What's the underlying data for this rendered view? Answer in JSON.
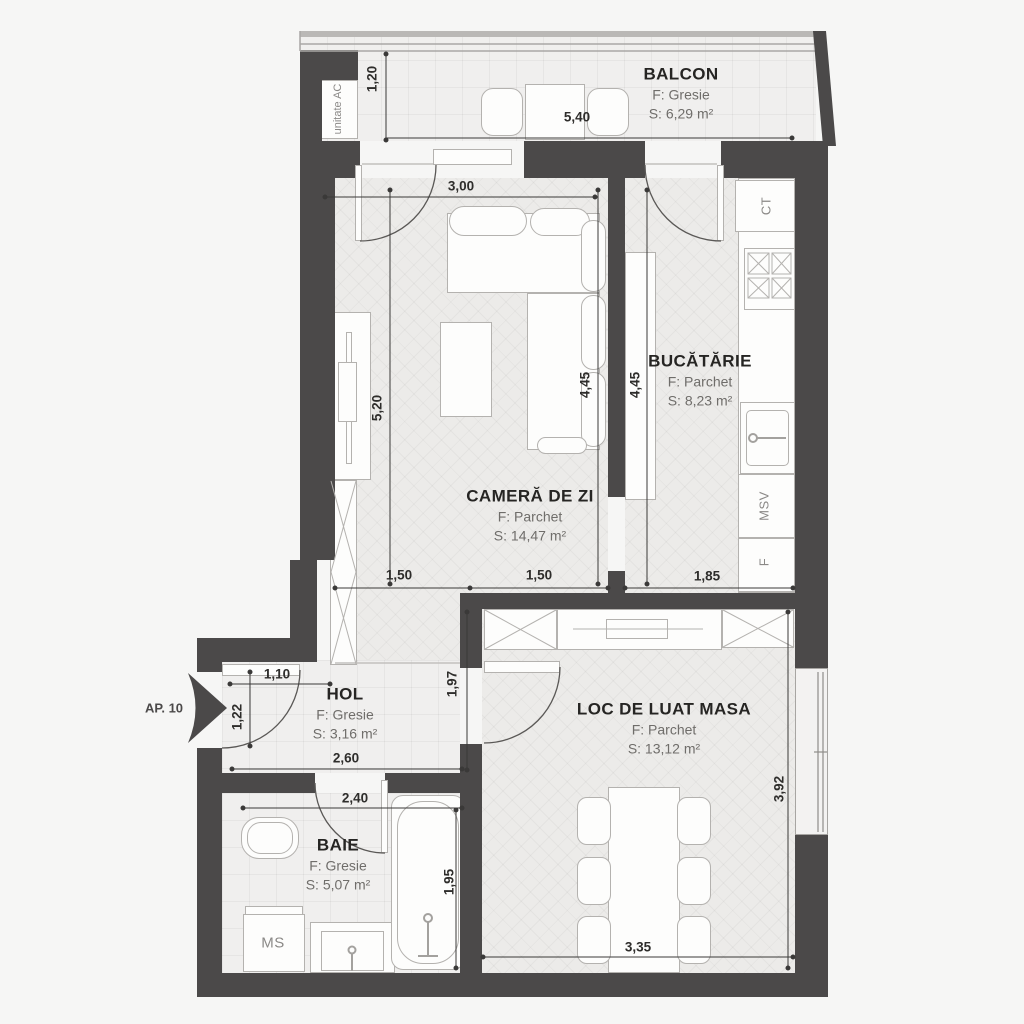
{
  "plan_title": "AP. 10",
  "rooms": {
    "balcon": {
      "name": "BALCON",
      "floor": "F: Gresie",
      "area": "S: 6,29 m²"
    },
    "camera": {
      "name": "CAMERĂ DE ZI",
      "floor": "F: Parchet",
      "area": "S: 14,47 m²"
    },
    "bucatarie": {
      "name": "BUCĂTĂRIE",
      "floor": "F: Parchet",
      "area": "S: 8,23 m²"
    },
    "hol": {
      "name": "HOL",
      "floor": "F: Gresie",
      "area": "S: 3,16 m²"
    },
    "baie": {
      "name": "BAIE",
      "floor": "F: Gresie",
      "area": "S: 5,07 m²"
    },
    "dining": {
      "name": "LOC DE LUAT MASA",
      "floor": "F: Parchet",
      "area": "S: 13,12 m²"
    }
  },
  "equipment": {
    "ac": "unitate AC",
    "ct": "CT",
    "msv": "MSV",
    "f": "F",
    "ms": "MS"
  },
  "dimensions": {
    "balcony_depth": "1,20",
    "balcony_width": "5,40",
    "living_width_top": "3,00",
    "living_height": "5,20",
    "living_height_right": "4,45",
    "kitchen_height": "4,45",
    "living_bottom_a": "1,50",
    "living_bottom_b": "1,50",
    "kitchen_bottom": "1,85",
    "hol_top": "1,10",
    "entry_side": "1,22",
    "hol_right": "1,97",
    "hol_bottom": "2,60",
    "bath_top": "2,40",
    "bath_side": "1,95",
    "dining_side": "3,92",
    "dining_bottom": "3,35"
  },
  "colors": {
    "wall": "#4b4949",
    "floor": "#ecebe9",
    "title_text": "#262523",
    "muted_text": "#6f6d6a"
  }
}
